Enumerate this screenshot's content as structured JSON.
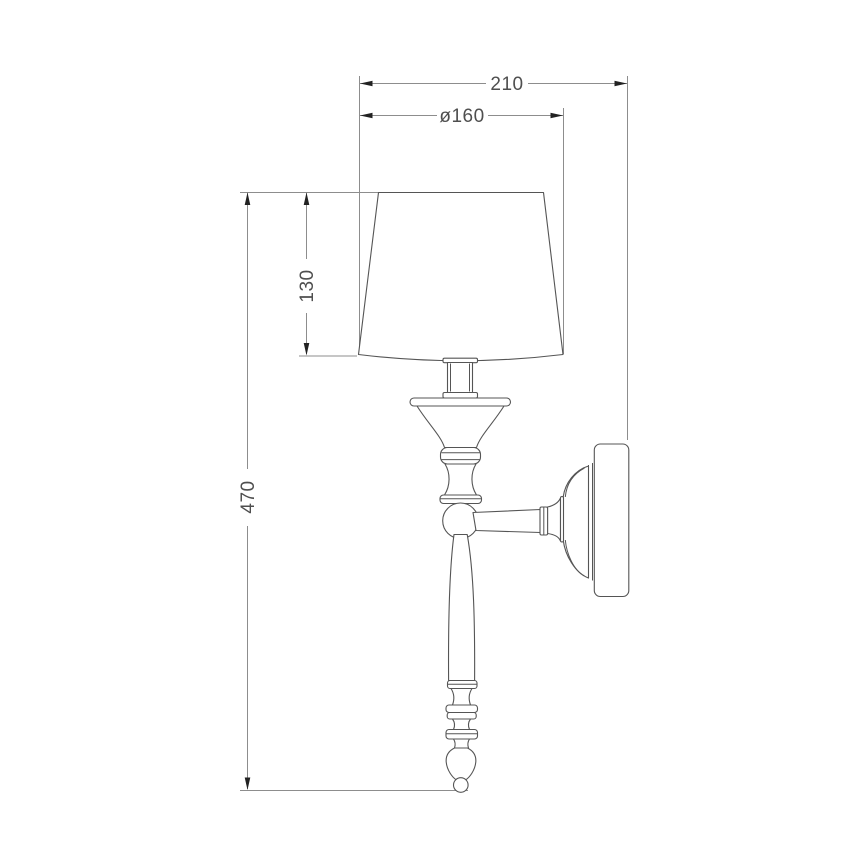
{
  "page": {
    "background": "#ffffff"
  },
  "colors": {
    "background": "#ffffff",
    "dimension-line": "#8d8d8d",
    "arrow": "#222222",
    "dimension-text": "#4f4f4f",
    "outline": "#555555",
    "fill": "#ffffff"
  },
  "drawing": {
    "type": "technical-dimension-drawing",
    "subject": "wall sconce lamp, side elevation",
    "dimensions": [
      {
        "id": "total-projection",
        "label": "210",
        "orientation": "horizontal"
      },
      {
        "id": "shade-diameter",
        "label": "ø160",
        "orientation": "horizontal"
      },
      {
        "id": "shade-height",
        "label": "130",
        "orientation": "vertical"
      },
      {
        "id": "overall-height",
        "label": "470",
        "orientation": "vertical"
      }
    ]
  }
}
